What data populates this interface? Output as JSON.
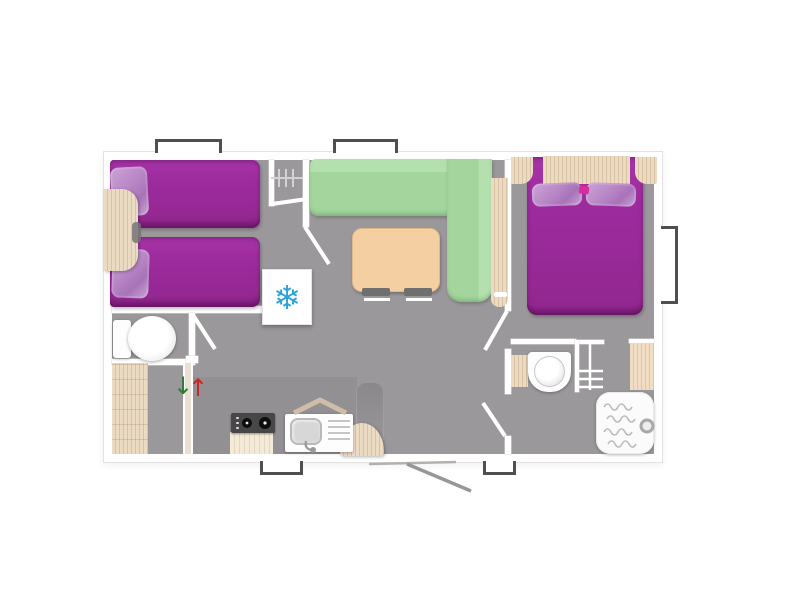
{
  "scene": {
    "type": "floor-plan",
    "view": "top-down",
    "subject": "two-bedroom mobile-home layout with living-kitchen area, wc and shower room"
  },
  "glyphs": {
    "freezer_snowflake": "❄",
    "entry_arrow_down": "↓",
    "entry_arrow_up": "↑"
  },
  "colors": {
    "floor": "#9b989b",
    "floor_dark": "#8d8a8d",
    "wall": "#ffffff",
    "bed_purple": "#9d2b9e",
    "pillow_lilac": "#b886c6",
    "sofa_green": "#a3d59d",
    "sofa_green_light": "#b4dfae",
    "table_tan": "#f3cfa1",
    "wood": "#ecdbc3",
    "wood_line": "#d9c2a4",
    "window_frame": "#4f4f4f",
    "snowflake_blue": "#2aa3dd",
    "arrow_green": "#2e7d32",
    "arrow_red": "#c62828",
    "appliance_dark": "#474747"
  },
  "rooms": [
    {
      "name": "twin-bedroom",
      "furniture": [
        "single-bed",
        "single-bed",
        "bedside-table",
        "wardrobe-with-hangers"
      ]
    },
    {
      "name": "wc",
      "furniture": [
        "toilet"
      ]
    },
    {
      "name": "entrance-hall",
      "furniture": [
        "storage-cabinet",
        "sliding-door"
      ]
    },
    {
      "name": "living-kitchen",
      "furniture": [
        "corner-sofa",
        "dining-table",
        "stools",
        "freezer",
        "gas-hob",
        "kitchen-sink",
        "side-table",
        "range-hood"
      ]
    },
    {
      "name": "master-bedroom",
      "furniture": [
        "double-bed",
        "headboard-shelf",
        "nightstand",
        "nightstand"
      ]
    },
    {
      "name": "bathroom",
      "furniture": [
        "washbasin",
        "shelf-unit",
        "shower-tray",
        "towel-panel"
      ]
    }
  ],
  "openings": {
    "windows_top": 2,
    "windows_bottom": 2,
    "windows_right": 1,
    "entrance_door": "bottom-center",
    "interior_doors": 5
  }
}
